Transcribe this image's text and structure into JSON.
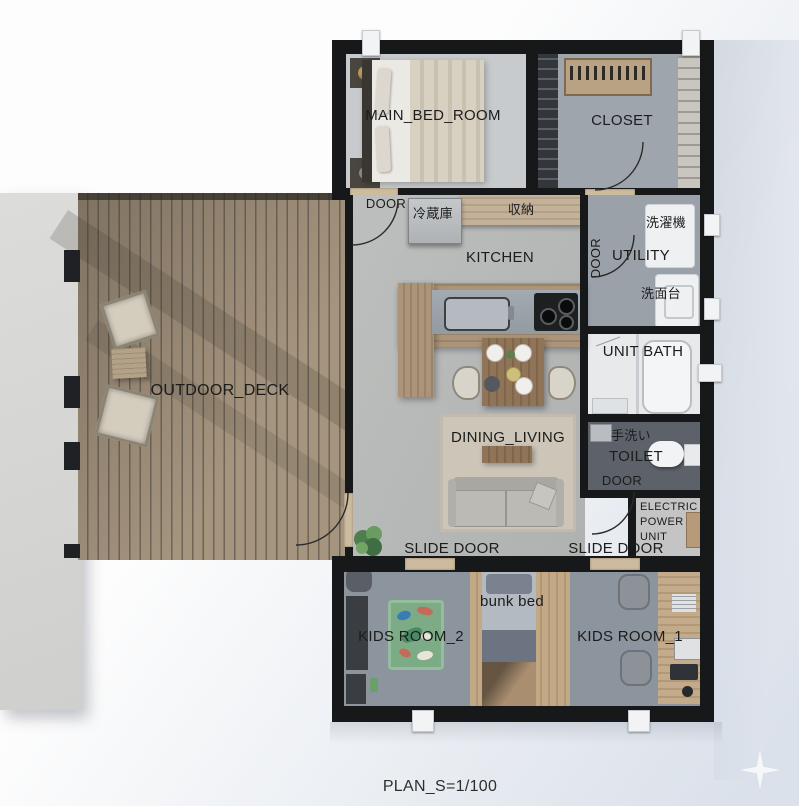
{
  "labels": {
    "main_bed_room": "MAIN_BED_ROOM",
    "closet": "CLOSET",
    "bedroom_door": "DOOR",
    "fridge": "冷蔵庫",
    "storage": "収納",
    "kitchen": "KITCHEN",
    "utility_door": "DOOR",
    "washing_machine": "洗濯機",
    "utility": "UTILITY",
    "washbasin": "洗面台",
    "unit_bath": "UNIT BATH",
    "hand_wash": "手洗い",
    "toilet": "TOILET",
    "toilet_door": "DOOR",
    "electric_power_unit": "ELECTRIC\nPOWER\nUNIT",
    "outdoor_deck": "OUTDOOR_DECK",
    "dining_living": "DINING_LIVING",
    "slide_door_left": "SLIDE DOOR",
    "slide_door_right": "SLIDE DOOR",
    "kids_room_2": "KIDS ROOM_2",
    "kids_room_1": "KIDS ROOM_1",
    "bunk_bed": "bunk bed",
    "plan_scale": "PLAN_S=1/100"
  },
  "colors": {
    "wall": "#17181a",
    "deck_wood": "#a5947e",
    "deck_plank_line": "#6e655f",
    "floor_main": "#b6b8b7",
    "floor_kids": "#8c949e",
    "floor_toilet": "#5d626a",
    "floor_bath": "#e7e9eb",
    "floor_closet": "#9fa5ad",
    "rug": "#ccc5b8",
    "wood_furniture": "#ab9479",
    "kids_mat_green": "#7dab86",
    "label_text": "#1c1c1c"
  }
}
